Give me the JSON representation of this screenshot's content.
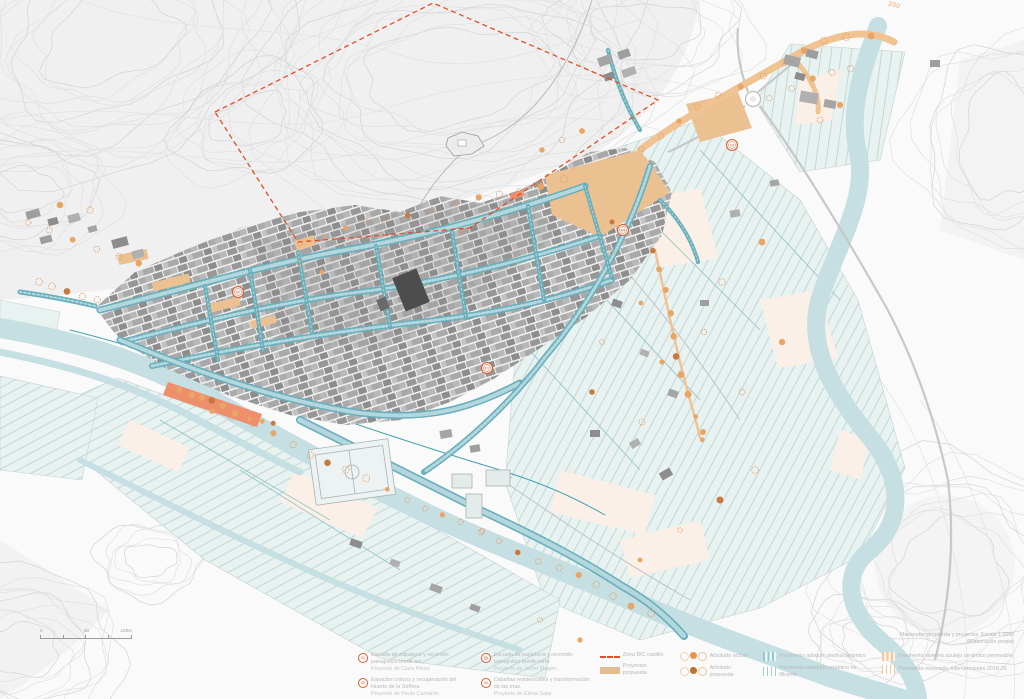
{
  "colors": {
    "street_teal": "#68afbc",
    "river_blue": "#c5dfe3",
    "field_teal": "#e7f2f1",
    "project_tan": "#e8bd8f",
    "marker_orange": "#dd5b2e",
    "bic_dash_red": "#e14f22",
    "tree_orange": "#e49a5e"
  },
  "map": {
    "contour_label": "200",
    "markers": [
      {
        "label": "01"
      },
      {
        "label": "02"
      },
      {
        "label": "03"
      },
      {
        "label": "04"
      }
    ],
    "scalebar": {
      "t0": "0",
      "t50": "50",
      "t100": "100m"
    },
    "caption": {
      "line1": "Masterplan propuesta y proyectos. Escala 1:2500",
      "line2": "(Elaboración propia)"
    }
  },
  "legend": {
    "projects": [
      {
        "num": "01",
        "line1": "Escuela de zapatería y recorrido paisajístico borde sur.",
        "line2": "Proyecto de Clara Pérez"
      },
      {
        "num": "02",
        "line1": "Espacios cívicos y recuperación del Huerto de la Señora.",
        "line2": "Proyecto de Paula Camarón"
      },
      {
        "num": "03",
        "line1": "Escuela de pastelería y recorrido paisajístico borde norte.",
        "line2": "Proyecto de Javier Magén"
      },
      {
        "num": "04",
        "line1": "Cabañas residenciales y transformación de las eras.",
        "line2": "Proyecto de Elena Salar"
      }
    ],
    "zona_bic": "Zona BIC castillo",
    "proyectos": "Proyectos propuesta",
    "arbolado_actual": "Arbolado actual",
    "arbolado_propuesta": "Arbolado propuesta",
    "pav_piedra": "Pavimento adoquín piedra/cerámico",
    "pav_ceramico": "Pavimento adoquín cerámico no filtrante",
    "pav_azulejo": "Pavimento sistema azulejo cerámico permeable",
    "pav_renovado": "Pavimento renovado, intervenciones 2018-20"
  }
}
